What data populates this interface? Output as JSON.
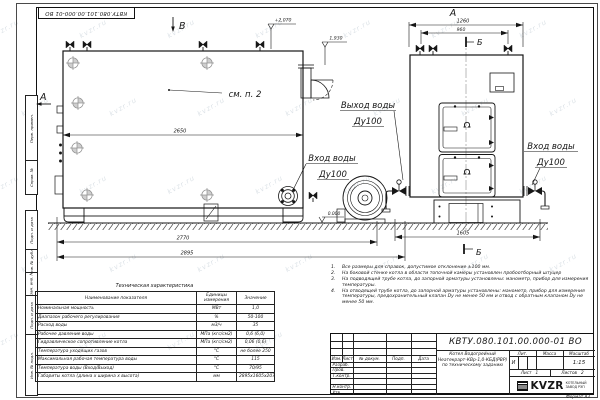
{
  "watermark": {
    "text": "kvzr.ru"
  },
  "stamp_top": {
    "number": "КВТУ.080.101.00.000-01  ВО"
  },
  "frame": {
    "sidebar": [
      "Перв. примен.",
      "Справ. №",
      "Подп. и дата",
      "Инв. № дубл.",
      "Взам. инв. №",
      "Подп. и дата",
      "Инв. № подл."
    ],
    "format_note": "Формат  А3"
  },
  "drawing": {
    "front_view": {
      "view_label_b": "В",
      "section_label_a": "А",
      "see_note": "см. п. 2",
      "dim_width_inner": "2650",
      "dim_width_mid": "2770",
      "dim_width_full": "2895",
      "elev_top": "+2,070",
      "elev_flue": "1,930",
      "elev_zero": "0.000",
      "inlet_line1": "Вход воды",
      "inlet_line2": "Ду100",
      "outlet_line1": "Выход воды",
      "outlet_line2": "Ду100"
    },
    "rear_view": {
      "view_label": "А",
      "section_label_top": "Б",
      "section_label_bottom": "Б",
      "dim_top_full": "1260",
      "dim_top_inner": "960",
      "dim_bottom": "1605",
      "inlet_line1": "Вход воды",
      "inlet_line2": "Ду100"
    }
  },
  "notes": {
    "items": [
      {
        "n": "1.",
        "text": "Все размеры для справок, допустимое отклонение ±100 мм."
      },
      {
        "n": "2.",
        "text": "На боковой стенке котла в области топочной камеры установлен пробоотборный штуцер"
      },
      {
        "n": "3.",
        "text": "На  подводящей трубе котла, до запорной арматуры установлены: манометр, прибор для измерения температуры."
      },
      {
        "n": "4.",
        "text": "На отводящей трубе котла, до запорной арматуры установлены: манометр, прибор для измерения температуры, предохранительный клапан Dу не менее 50 мм и отвод с обратным клапаном Dу не менее 50 мм."
      }
    ]
  },
  "spec_table": {
    "title": "Техническая характеристика",
    "col_name": "Наименование показателя",
    "col_units": "Единицы измерения",
    "col_value": "Значение",
    "rows": [
      {
        "name": "Номинальная мощность",
        "units": "МВт",
        "value": "1,0"
      },
      {
        "name": "Диапазон рабочего регулирования",
        "units": "%",
        "value": "50-100"
      },
      {
        "name": "Расход воды",
        "units": "м3/ч",
        "value": "35"
      },
      {
        "name": "Рабочее давление воды",
        "units": "МПа (кгс/см2)",
        "value": "0,6 (6,0)"
      },
      {
        "name": "Гидравлическое сопротивление котла",
        "units": "МПа (кгс/см2)",
        "value": "0,06 (0,6)"
      },
      {
        "name": "Температура уходящих газов",
        "units": "°С",
        "value": "не более 250"
      },
      {
        "name": "Максимальная рабочая температура воды",
        "units": "°С",
        "value": "115"
      },
      {
        "name": "Температура воды (Вход/Выход)",
        "units": "°С",
        "value": "70/95"
      },
      {
        "name": "Габариты котла (длина х ширина х высота)",
        "units": "мм",
        "value": "2895х1605х2070"
      }
    ]
  },
  "title_block": {
    "doc_number": "КВТУ.080.101.00.000-01  ВО",
    "cols": {
      "izm": "Изм.",
      "list": "Лист",
      "docnum": "№ докум.",
      "podp": "Подп.",
      "data": "Дата"
    },
    "sig_rows": [
      "Разраб.",
      "Пров.",
      "Т.контр.",
      "",
      "Н.контр.",
      "Утв."
    ],
    "name_line1": "Котел Водогрейный",
    "name_line2": "Неатекрарт-КВр-1,0-КБД(РВР)",
    "name_line3": "по техническому заданию",
    "lit_label": "Лит.",
    "mass_label": "Масса",
    "scale_label": "Масштаб",
    "lit_value": "И",
    "scale_value": "1:15",
    "sheet_label": "Лист",
    "sheet_value": "1",
    "sheets_label": "Листов",
    "sheets_value": "2",
    "logo_text": "KVZR",
    "logo_sub1": "КОТЕЛЬНЫЙ",
    "logo_sub2": "ЗАВОД РЭП"
  }
}
